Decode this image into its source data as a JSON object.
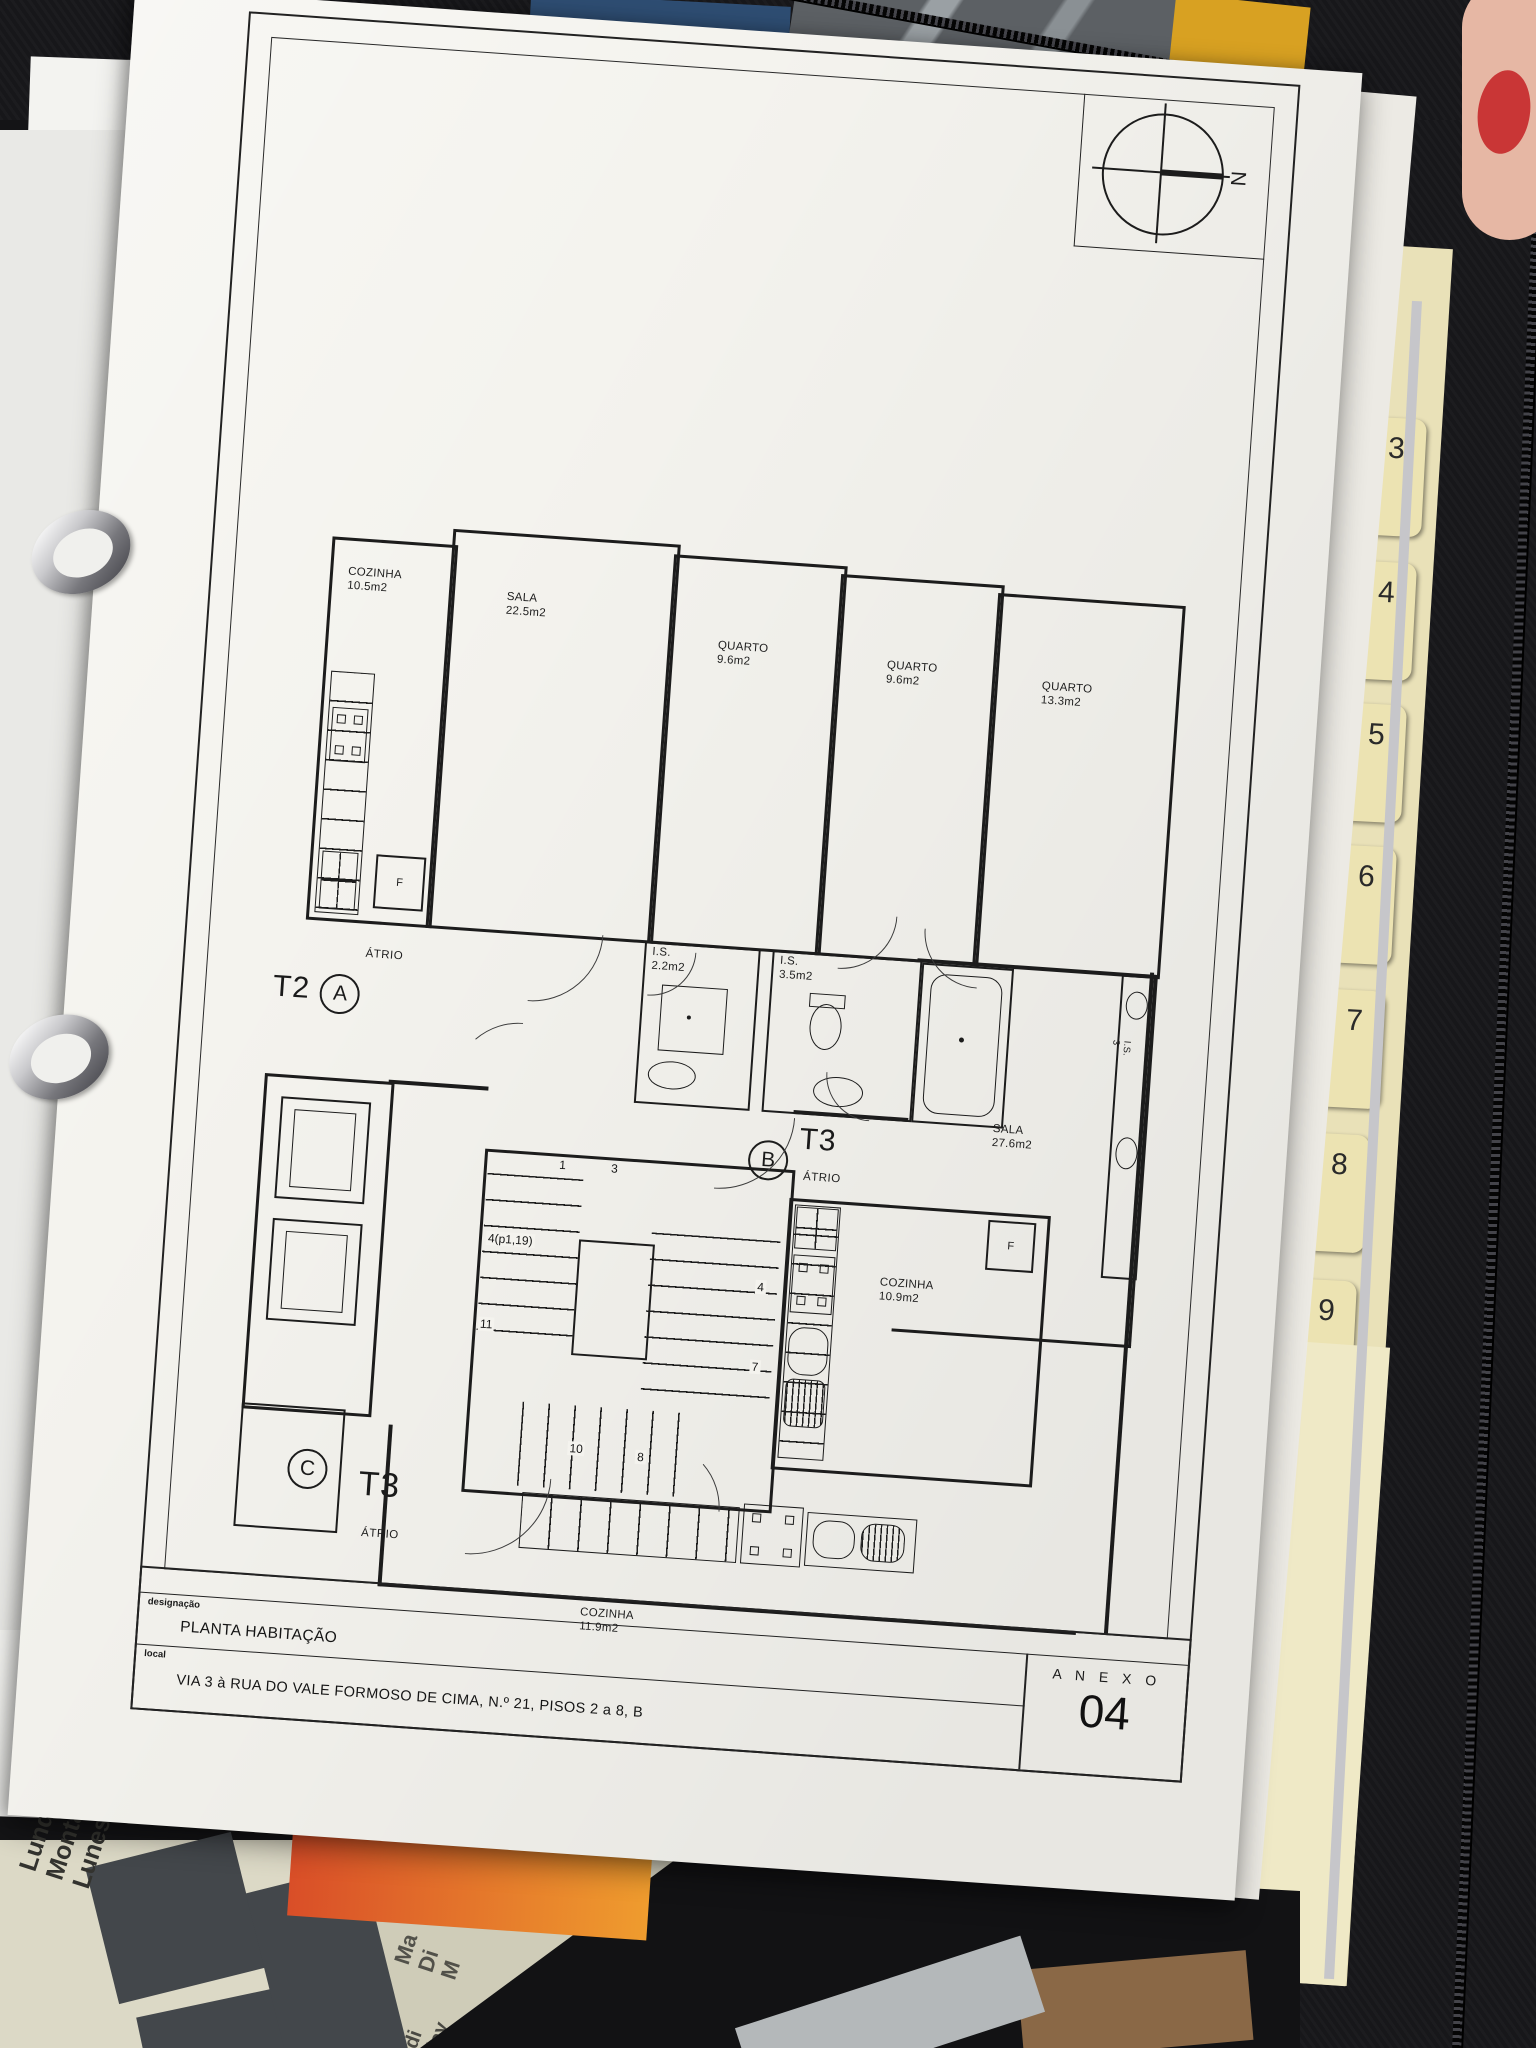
{
  "sheet": {
    "north_label": "N",
    "titleblock": {
      "designacao_label": "designação",
      "designacao_value": "PLANTA HABITAÇÃO",
      "local_label": "local",
      "local_value": "VIA 3 à RUA DO VALE FORMOSO DE CIMA, N.º 21, PISOS 2 a 8, B",
      "anexo_label": "A N E X O",
      "anexo_number": "04"
    }
  },
  "plan": {
    "atrio_label": "ÁTRIO",
    "fridge_label": "F",
    "rooms": {
      "sala_t2": {
        "name": "SALA",
        "area": "22.5m2"
      },
      "quarto1": {
        "name": "QUARTO",
        "area": "9.6m2"
      },
      "quarto2": {
        "name": "QUARTO",
        "area": "9.6m2"
      },
      "quarto3": {
        "name": "QUARTO",
        "area": "13.3m2"
      },
      "cozinha_t2": {
        "name": "COZINHA",
        "area": "10.5m2"
      },
      "is_small": {
        "name": "I.S.",
        "area": "2.2m2"
      },
      "is_big": {
        "name": "I.S.",
        "area": "3.5m2"
      },
      "sala_t3b": {
        "name": "SALA",
        "area": "27.6m2"
      },
      "cozinha_t3b": {
        "name": "COZINHA",
        "area": "10.9m2"
      },
      "cozinha_t3c": {
        "name": "COZINHA",
        "area": "11.9m2"
      },
      "is_edge": {
        "name": "I.S.",
        "area": "3"
      }
    },
    "units": {
      "a": {
        "type": "T2",
        "letter": "A"
      },
      "b": {
        "type": "T3",
        "letter": "B"
      },
      "c": {
        "type": "T3",
        "letter": "C"
      }
    },
    "stairs": {
      "n1": "1",
      "n3": "3",
      "n4p": "4(p1,19)",
      "n4": "4",
      "n11": "11",
      "n7": "7",
      "n10": "10",
      "n8": "8"
    }
  },
  "binder": {
    "tabs": [
      "3",
      "4",
      "5",
      "6",
      "7",
      "8",
      "9",
      "0",
      "2"
    ]
  },
  "desk": {
    "calendar_left": {
      "w1": "Lundi",
      "w2": "Montag",
      "w3": "Lunes"
    },
    "calendar_mid": {
      "w1": "Ma",
      "w2": "Di",
      "w3": "M"
    },
    "calendar_low": {
      "w1": "di",
      "w2": "day"
    }
  }
}
